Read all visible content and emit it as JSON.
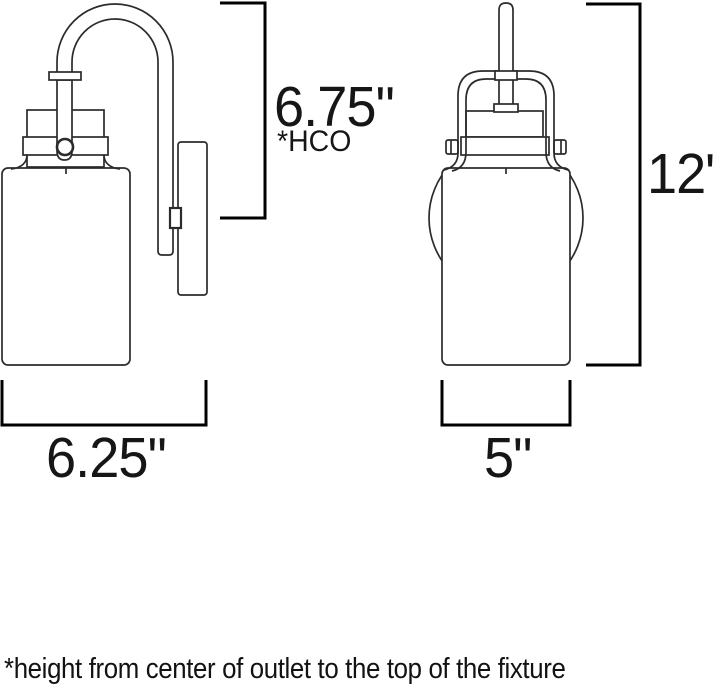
{
  "diagram": {
    "type": "technical-dimension-drawing",
    "subject": "wall sconce light fixture, side view and front view",
    "line_color": "#2b2b2b",
    "dimension_line_color": "#000000",
    "dimensions": {
      "hco": {
        "label": "6.75\"",
        "sub_label": "*HCO"
      },
      "overall_height": {
        "label": "12\""
      },
      "depth": {
        "label": "6.25\""
      },
      "width": {
        "label": "5\""
      }
    },
    "footnote": "*height from center of outlet to the top of the fixture"
  }
}
